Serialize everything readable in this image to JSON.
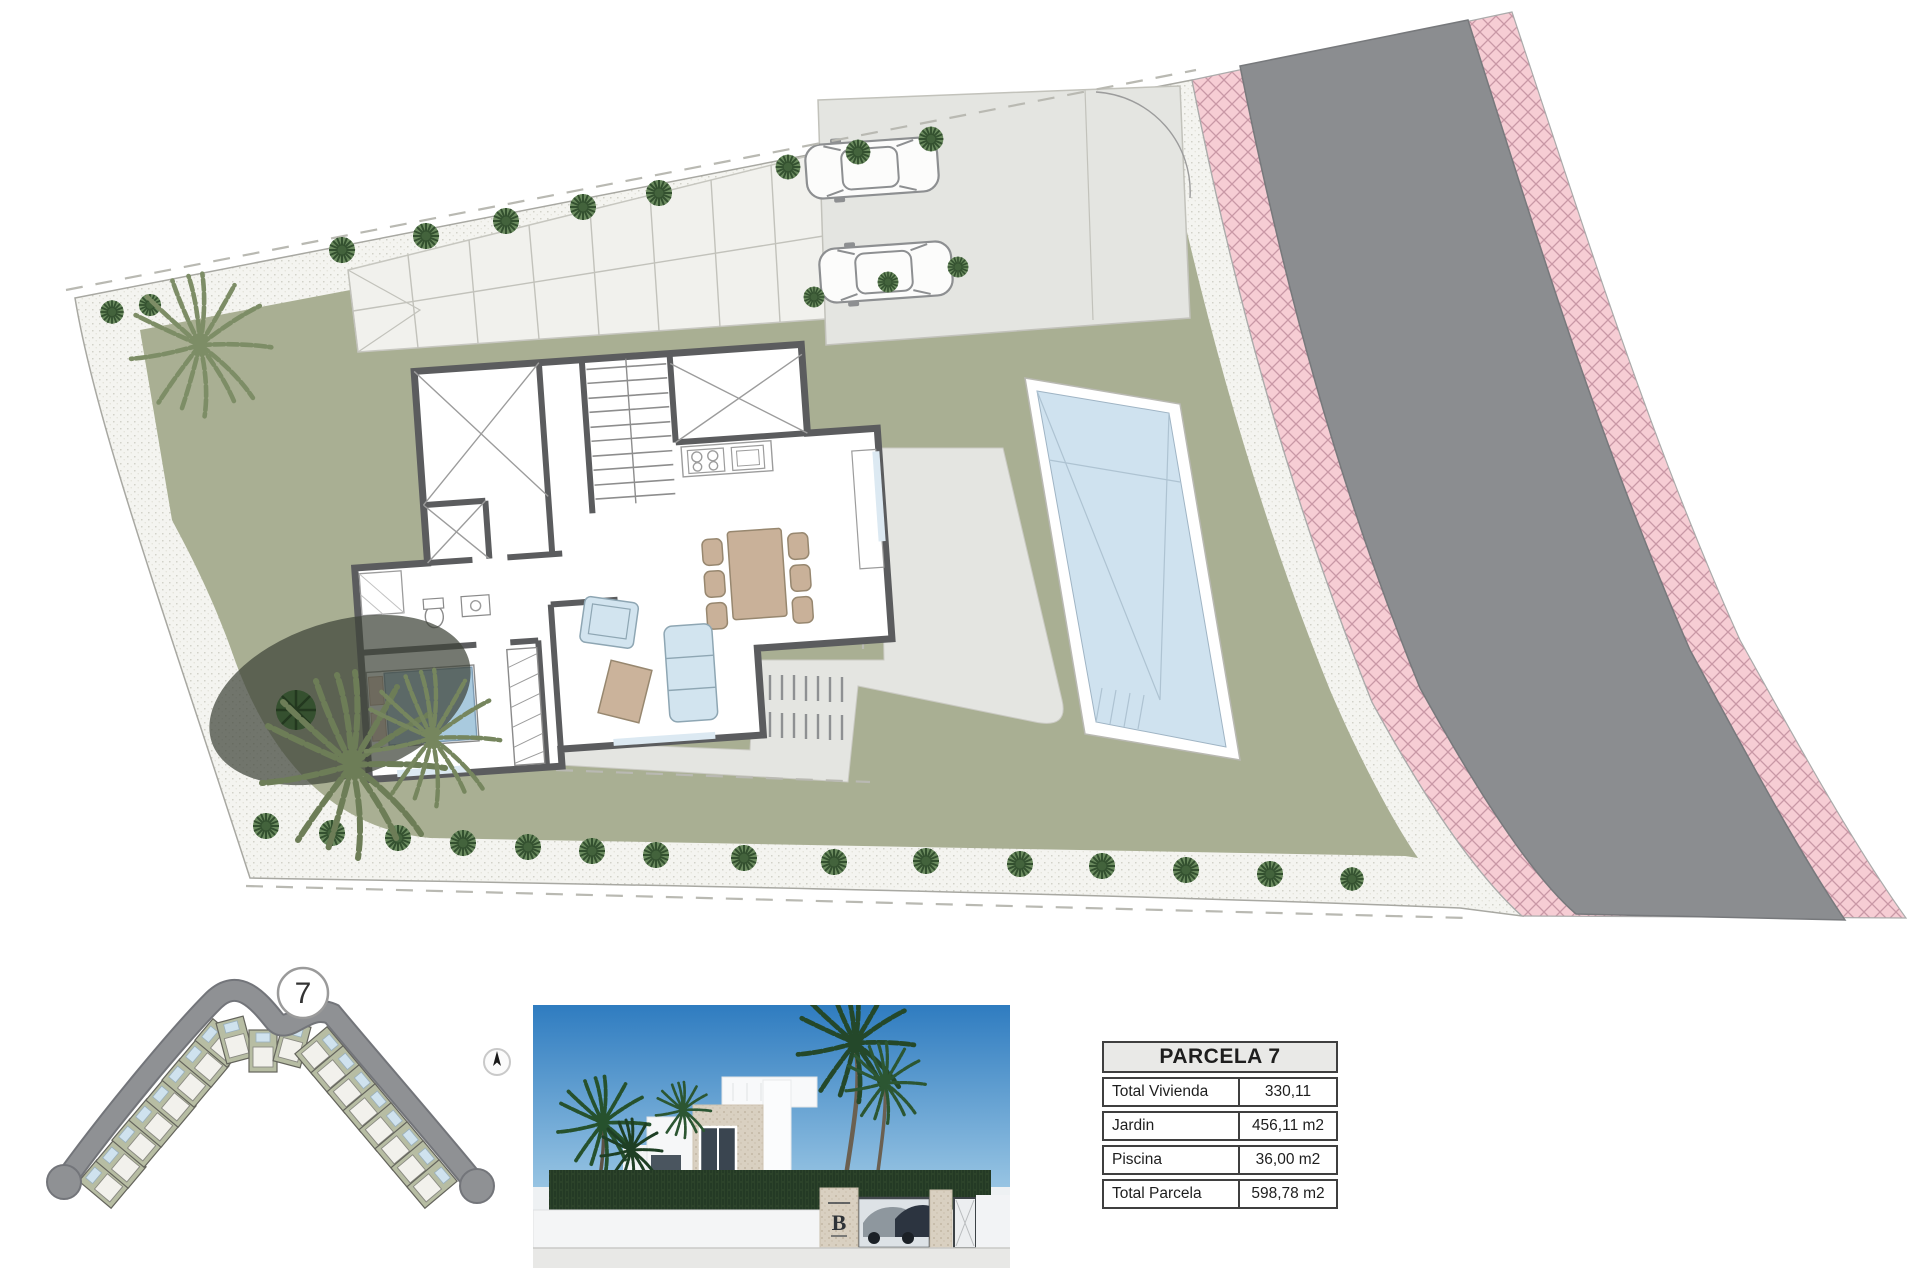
{
  "site_map": {
    "lot_marker": "7"
  },
  "photo": {
    "gate_logo": "B"
  },
  "parcel_table": {
    "title": "PARCELA 7",
    "rows": [
      {
        "label": "Total Vivienda",
        "value": "330,11"
      },
      {
        "label": "Jardin",
        "value": "456,11 m2"
      },
      {
        "label": "Piscina",
        "value": "36,00 m2"
      },
      {
        "label": "Total Parcela",
        "value": "598,78 m2"
      }
    ]
  },
  "colors": {
    "lawn": "#a9af93",
    "road": "#8b8d90",
    "sidewalk_pink": "#f6cdd4",
    "pool": "#cfe2ef",
    "gravel": "#f4f4f0",
    "terrace": "#e4e5e1",
    "wall": "#5b5c5e",
    "table_border": "#3f3f3f"
  }
}
